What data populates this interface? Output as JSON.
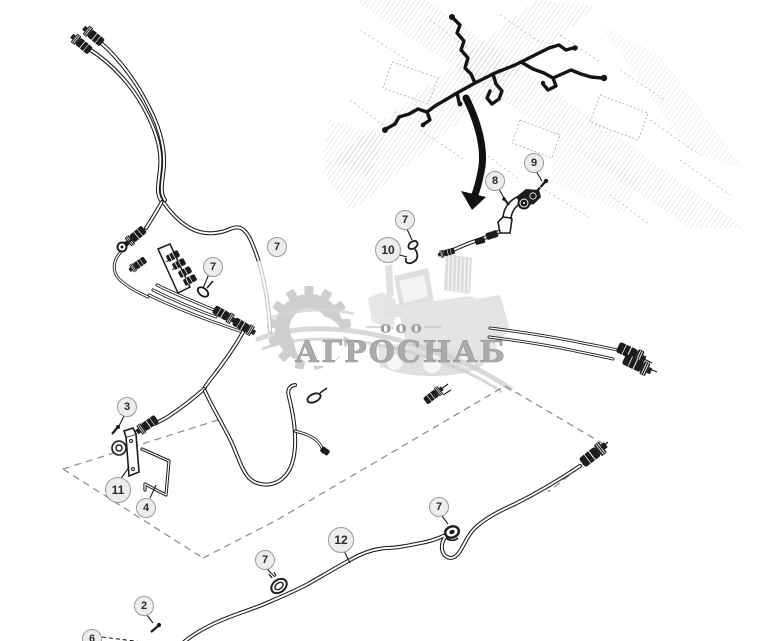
{
  "watermark": {
    "prefix": "ооо",
    "company": "АГРОСНАБ"
  },
  "callouts": [
    {
      "label": "7",
      "x": 277,
      "y": 247
    },
    {
      "label": "7",
      "x": 213,
      "y": 267
    },
    {
      "label": "7",
      "x": 405,
      "y": 220
    },
    {
      "label": "10",
      "x": 388,
      "y": 250
    },
    {
      "label": "8",
      "x": 495,
      "y": 181
    },
    {
      "label": "9",
      "x": 534,
      "y": 163
    },
    {
      "label": "3",
      "x": 127,
      "y": 407
    },
    {
      "label": "11",
      "x": 118,
      "y": 490
    },
    {
      "label": "4",
      "x": 146,
      "y": 508
    },
    {
      "label": "12",
      "x": 341,
      "y": 540
    },
    {
      "label": "7",
      "x": 439,
      "y": 507
    },
    {
      "label": "7",
      "x": 265,
      "y": 560
    },
    {
      "label": "2",
      "x": 144,
      "y": 606
    },
    {
      "label": "6",
      "x": 92,
      "y": 639
    }
  ],
  "colors": {
    "ink": "#1a1a1a",
    "callout_fill": "#ededed",
    "callout_border": "#9a9a9a",
    "watermark_gray": "#9f9f9f",
    "faded_cable_gray": "#c2c2c2"
  }
}
